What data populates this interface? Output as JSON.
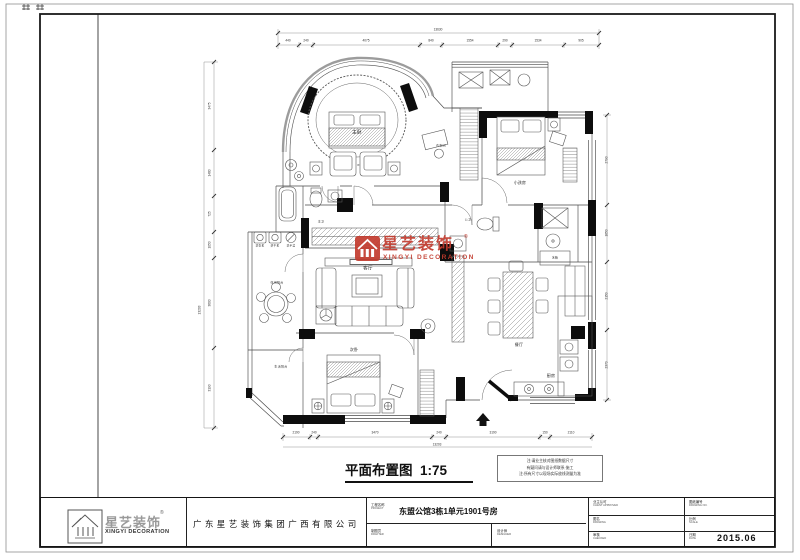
{
  "drawing": {
    "caption": {
      "title": "平面布置图",
      "scale": "1:75"
    },
    "notes": {
      "line1": "注:请业主核对图纸数据尺寸",
      "line2": "有疑问请与设计师联系·施工",
      "line3": "注:所有尺寸以现场实际放线测量为准"
    },
    "watermark": {
      "name_cn": "星艺装饰",
      "name_en": "XINGYI DECORATION",
      "reg": "®",
      "color": "#c23b2e"
    },
    "rooms": {
      "master": "主卧",
      "cloak": "衣帽间",
      "kids": "小孩房",
      "master_bath": "主卫",
      "guest_bath": "公卫",
      "living": "客厅",
      "dining": "餐厅",
      "kitchen": "厨房",
      "second": "次卧",
      "balcony_leisure": "休闲阳台",
      "balcony_life": "生活阳台"
    },
    "appliances": {
      "washer": "洗衣机",
      "dryer": "烘干机",
      "basin": "洗手盆",
      "fridge": "冰箱"
    },
    "dims": {
      "top": [
        "440",
        "240",
        "4075",
        "840",
        "1554",
        "290",
        "1534",
        "905"
      ],
      "top_total": "13630",
      "bottom": [
        "2190",
        "240",
        "3470",
        "240",
        "3190",
        "150",
        "2110"
      ],
      "bottom_total": "13203",
      "left": [
        "3475",
        "1480",
        "725",
        "1050",
        "3600",
        "3190"
      ],
      "left_total": "13203",
      "right": [
        "2790",
        "1650",
        "2150",
        "2370"
      ]
    }
  },
  "title_block": {
    "company": "广东星艺装饰集团广西有限公司",
    "logo": {
      "cn": "星艺装饰",
      "en": "XINGYI DECORATION",
      "reg": "®"
    },
    "project": {
      "label": "工程名称",
      "sub": "PROJECT",
      "value": "东盟公馆3栋1单元1901号房"
    },
    "drafter": {
      "label": "制图员",
      "sub": "DRAFTER"
    },
    "designer": {
      "label": "设计师",
      "sub": "DESIGNER"
    },
    "client": {
      "label": "业主认可",
      "sub": "CLIENT APPROVED"
    },
    "drawing_name": {
      "label": "图名",
      "sub": "DRAWING"
    },
    "checker": {
      "label": "审核",
      "sub": "CHECKED"
    },
    "drawing_no": {
      "label": "图纸编号",
      "sub": "DRAWING NO."
    },
    "scale": {
      "label": "比例",
      "sub": "SCALE"
    },
    "date": {
      "label": "日期",
      "sub": "DATE",
      "value": "2015.06"
    }
  }
}
